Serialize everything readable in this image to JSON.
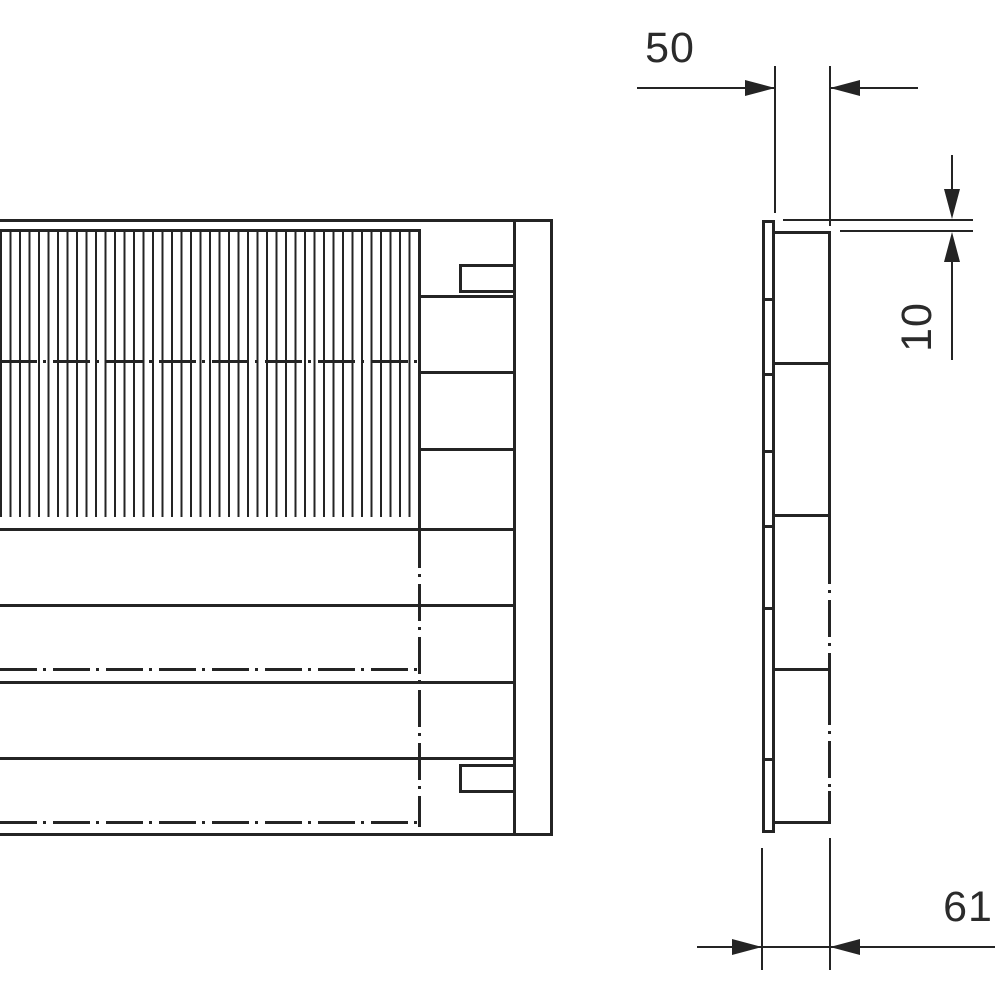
{
  "drawing": {
    "kind": "technical-drawing",
    "colors": {
      "line": "#242424",
      "background": "#ffffff"
    },
    "views": {
      "front": {
        "features": [
          "finned-area",
          "segmented-terminal-column",
          "center-lines"
        ]
      },
      "side": {
        "features": [
          "mounting-plate",
          "fin-body",
          "hidden-edge-dash-dot"
        ]
      }
    },
    "dimensions": {
      "depth_body": {
        "label": "50"
      },
      "offset_top": {
        "label": "10"
      },
      "depth_total": {
        "label": "61"
      }
    }
  }
}
